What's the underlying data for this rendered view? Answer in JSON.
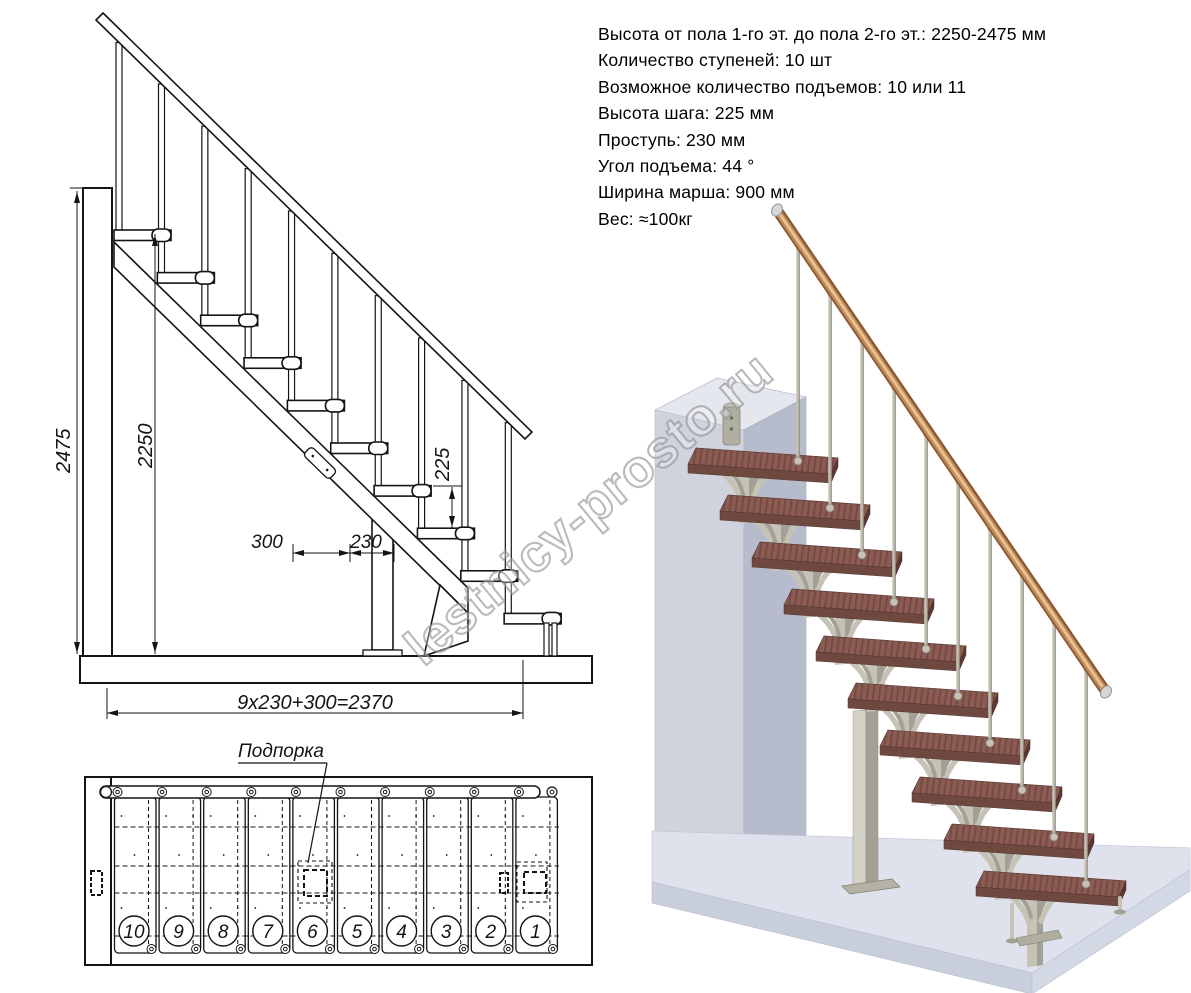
{
  "specs": {
    "lines": [
      "Высота от пола 1-го эт. до пола 2-го эт.: 2250-2475 мм",
      "Количество ступеней: 10 шт",
      "Возможное количество подъемов: 10 или 11",
      "Высота шага: 225 мм",
      "Проступь: 230 мм",
      "Угол подъема: 44 °",
      "Ширина марша: 900 мм",
      "Вес: ≈100кг"
    ]
  },
  "side_view": {
    "dim_total_height": "2475",
    "dim_stair_height": "2250",
    "dim_riser": "225",
    "dim_depth": "300",
    "dim_run": "230",
    "dim_total_run": "9x230+300=2370"
  },
  "plan_view": {
    "support_label": "Подпорка",
    "step_numbers": [
      "10",
      "9",
      "8",
      "7",
      "6",
      "5",
      "4",
      "3",
      "2",
      "1"
    ]
  },
  "steps_count": 10,
  "watermark": {
    "text": "lestnicy-prosto.ru"
  },
  "colors": {
    "line": "#141414",
    "tread_top": "#8b5c54",
    "tread_front": "#6f4840",
    "tread_side": "#5b3833",
    "metal": "#c6c2b5",
    "metal_dark": "#a3a096",
    "metal_edge": "#87857b",
    "rail_dark": "#8a5733",
    "rail_mid": "#c08a57",
    "rail_highlight": "#e7c094",
    "cap_metal": "#d6d6d8",
    "wall_front": "#cfd3de",
    "wall_side": "#b6bccb",
    "wall_top": "#e4e7ee",
    "bracket": "#b0aea1",
    "floor_top": "#dfe2ed",
    "floor_front": "#c9cedd",
    "floor_right": "#d3d8e5",
    "watermark": "#8f8f8f"
  }
}
